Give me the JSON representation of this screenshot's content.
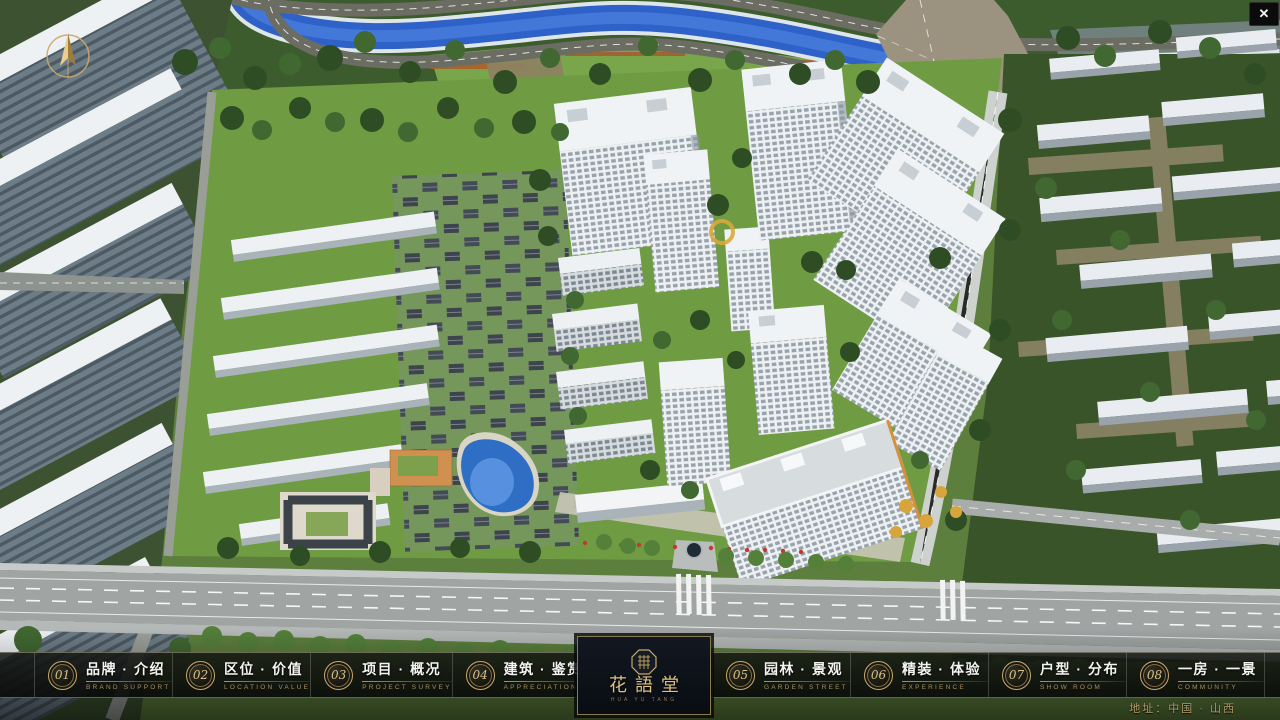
{
  "window": {
    "close_label": "✕"
  },
  "logo": {
    "title": "花語堂",
    "subtitle": "HUA YU TANG"
  },
  "nav": {
    "items": [
      {
        "num": "01",
        "cn": "品牌 · 介绍",
        "en": "BRAND SUPPORT"
      },
      {
        "num": "02",
        "cn": "区位 · 价值",
        "en": "LOCATION VALUE"
      },
      {
        "num": "03",
        "cn": "项目 · 概况",
        "en": "PROJECT SURVEY"
      },
      {
        "num": "04",
        "cn": "建筑 · 鉴赏",
        "en": "APPRECIATION"
      },
      {
        "num": "05",
        "cn": "园林 · 景观",
        "en": "GARDEN STREET"
      },
      {
        "num": "06",
        "cn": "精装 · 体验",
        "en": "EXPERIENCE"
      },
      {
        "num": "07",
        "cn": "户型 · 分布",
        "en": "SHOW ROOM"
      },
      {
        "num": "08",
        "cn": "一房 · 一景",
        "en": "COMMUNITY"
      }
    ]
  },
  "footer": {
    "address": "地址：中国 · 山西"
  },
  "colors": {
    "gold": "#c9a86a",
    "gold_dim": "#a8905e",
    "bar_bg": "#0c0e0c",
    "river_blue": "#2e62c8",
    "grass_green": "#6f9c42",
    "tree_green": "#36522a",
    "road_grey": "#a0a5a4",
    "tower_white": "#eef1f3"
  }
}
